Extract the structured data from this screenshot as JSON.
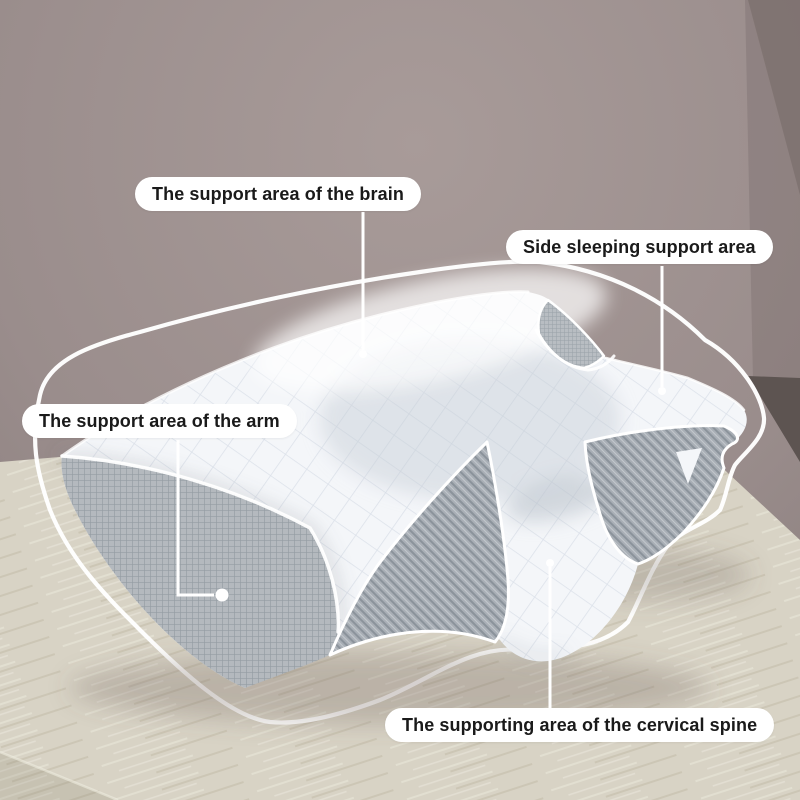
{
  "annotations": {
    "brain": "The support area of the brain",
    "side_sleeping": "Side sleeping support area",
    "arm": "The support area of the arm",
    "cervical_spine": "The supporting area of the cervical spine"
  },
  "colors": {
    "wall": "#9a8d8c",
    "wall_dark_corner": "#5d5451",
    "table_surface": "#d8d3c5",
    "pillow_white": "#f4f6f9",
    "pillow_mesh_gray": "#aab0b7",
    "contour_outline": "#ffffff",
    "callout_line": "#ffffff",
    "label_background": "#ffffff",
    "label_text": "#1a1a1a"
  }
}
